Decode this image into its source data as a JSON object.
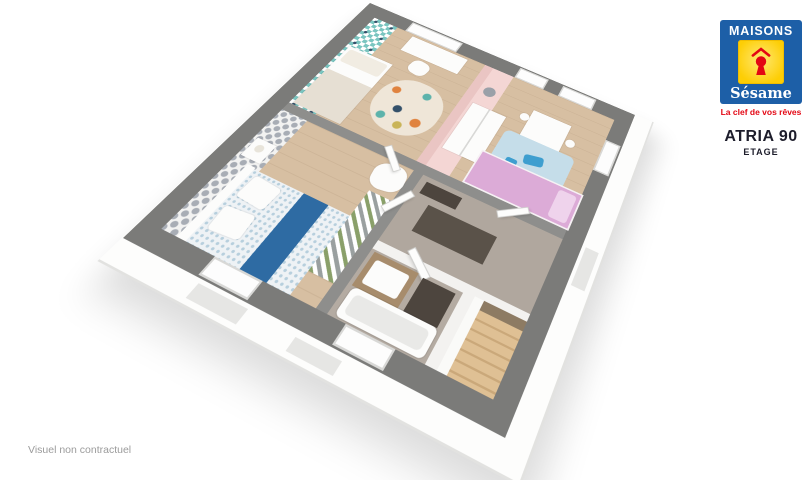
{
  "brand": {
    "name_top": "MAISONS",
    "name_script": "Sésame",
    "tagline": "La clef de vos rêves",
    "colors": {
      "blue": "#1d5fa7",
      "yellow": "#fdce05",
      "red": "#e30613"
    }
  },
  "plan_title": {
    "model": "ATRIA 90",
    "level": "ETAGE"
  },
  "footer": {
    "disclaimer": "Visuel non contractuel"
  },
  "floorplan": {
    "view": "3d-cutaway-perspective",
    "rooms": [
      "bedroom-teal",
      "bedroom-pink",
      "bedroom-master",
      "hallway",
      "bathroom",
      "staircase"
    ],
    "colors": {
      "exterior_wall_gray": "#7b7b79",
      "interior_wall_white": "#f3f2f0",
      "wood_floor": "#d7bfa2",
      "hall_floor": "#b0a79e",
      "teal_wallpaper": "#7ac5c0",
      "damask_gray": "#a8adb5",
      "pink_wall": "#eac5c3",
      "kid_bed_pink": "#dcabd7",
      "bed_runner_blue": "#2e6ba3",
      "stairs_wood": "#dfc094"
    }
  }
}
